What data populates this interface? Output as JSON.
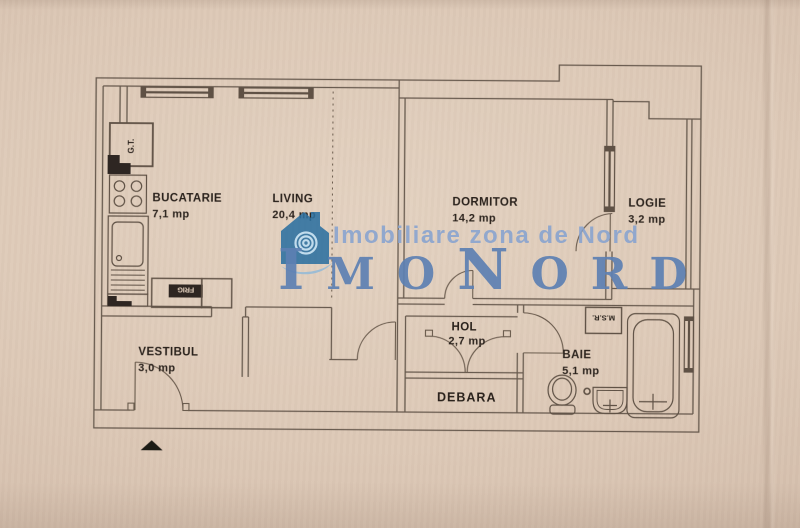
{
  "watermark": {
    "tagline": "Imobiliare zona de Nord",
    "brand": {
      "part1": "I",
      "part2": "MO",
      "part3": "N",
      "part4": "ORD"
    },
    "colors": {
      "logo_blue": "#2c6f9f",
      "logo_swirl": "#cfe7f5",
      "swoosh_blue": "#8cb8da",
      "tagline_blue": "#87a3d0",
      "brand_blue": "#5d80b3"
    }
  },
  "floor_plan": {
    "line_color": "#5e5145",
    "paper_color": "#ddc9b7",
    "rooms": [
      {
        "name": "BUCATARIE",
        "area": "7,1 mp"
      },
      {
        "name": "LIVING",
        "area": "20,4 mp"
      },
      {
        "name": "DORMITOR",
        "area": "14,2 mp"
      },
      {
        "name": "LOGIE",
        "area": "3,2 mp"
      },
      {
        "name": "VESTIBUL",
        "area": "3,0 mp"
      },
      {
        "name": "HOL",
        "area": "2,7 mp"
      },
      {
        "name": "DEBARA"
      },
      {
        "name": "BAIE",
        "area": "5,1 mp"
      }
    ],
    "labels": {
      "gas_meter": "G.T.",
      "fridge": "FRIG",
      "washing_machine": "M.S.R."
    }
  }
}
